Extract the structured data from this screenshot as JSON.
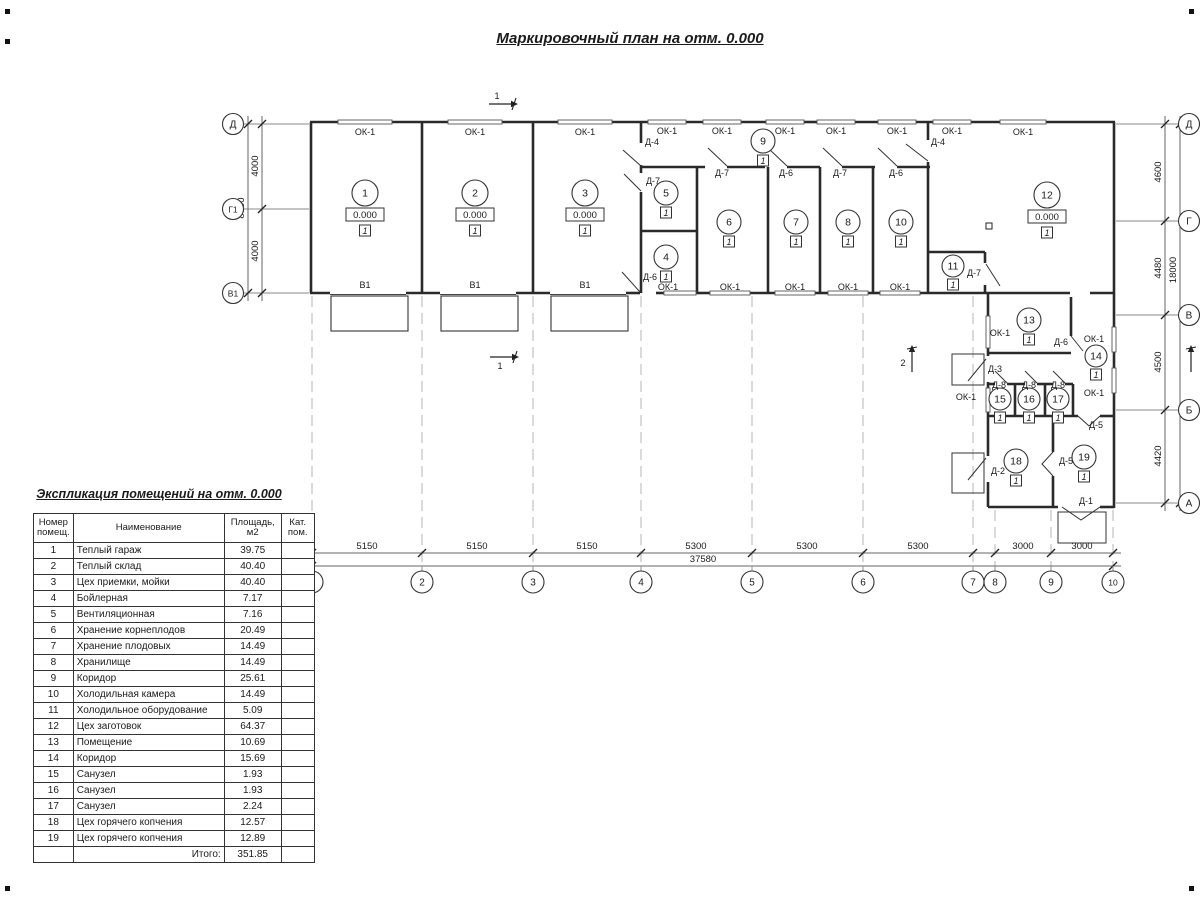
{
  "title": "Маркировочный план на отм. 0.000",
  "explication": {
    "title": "Экспликация помещений на отм. 0.000",
    "headers": {
      "number": "Номер помещ.",
      "name": "Наименование",
      "area": "Площадь, м2",
      "category": "Кат. пом."
    },
    "rows": [
      {
        "number": "1",
        "name": "Теплый гараж",
        "area": "39.75",
        "category": ""
      },
      {
        "number": "2",
        "name": "Теплый склад",
        "area": "40.40",
        "category": ""
      },
      {
        "number": "3",
        "name": "Цех приемки, мойки",
        "area": "40.40",
        "category": ""
      },
      {
        "number": "4",
        "name": "Бойлерная",
        "area": "7.17",
        "category": ""
      },
      {
        "number": "5",
        "name": "Вентиляционная",
        "area": "7.16",
        "category": ""
      },
      {
        "number": "6",
        "name": "Хранение корнеплодов",
        "area": "20.49",
        "category": ""
      },
      {
        "number": "7",
        "name": "Хранение плодовых",
        "area": "14.49",
        "category": ""
      },
      {
        "number": "8",
        "name": "Хранилище",
        "area": "14.49",
        "category": ""
      },
      {
        "number": "9",
        "name": "Коридор",
        "area": "25.61",
        "category": ""
      },
      {
        "number": "10",
        "name": "Холодильная камера",
        "area": "14.49",
        "category": ""
      },
      {
        "number": "11",
        "name": "Холодильное оборудование",
        "area": "5.09",
        "category": ""
      },
      {
        "number": "12",
        "name": "Цех заготовок",
        "area": "64.37",
        "category": ""
      },
      {
        "number": "13",
        "name": "Помещение",
        "area": "10.69",
        "category": ""
      },
      {
        "number": "14",
        "name": "Коридор",
        "area": "15.69",
        "category": ""
      },
      {
        "number": "15",
        "name": "Санузел",
        "area": "1.93",
        "category": ""
      },
      {
        "number": "16",
        "name": "Санузел",
        "area": "1.93",
        "category": ""
      },
      {
        "number": "17",
        "name": "Санузел",
        "area": "2.24",
        "category": ""
      },
      {
        "number": "18",
        "name": "Цех горячего копчения",
        "area": "12.57",
        "category": ""
      },
      {
        "number": "19",
        "name": "Цех горячего копчения",
        "area": "12.89",
        "category": ""
      }
    ],
    "total_label": "Итого:",
    "total_value": "351.85"
  },
  "plan": {
    "rooms": [
      {
        "n": "1",
        "x": 365,
        "y": 193,
        "r": 13,
        "elevation": "0.000",
        "floor": "1"
      },
      {
        "n": "2",
        "x": 475,
        "y": 193,
        "r": 13,
        "elevation": "0.000",
        "floor": "1"
      },
      {
        "n": "3",
        "x": 585,
        "y": 193,
        "r": 13,
        "elevation": "0.000",
        "floor": "1"
      },
      {
        "n": "4",
        "x": 666,
        "y": 257,
        "r": 12,
        "floor": "1"
      },
      {
        "n": "5",
        "x": 666,
        "y": 193,
        "r": 12,
        "floor": "1"
      },
      {
        "n": "6",
        "x": 729,
        "y": 222,
        "r": 12,
        "floor": "1"
      },
      {
        "n": "7",
        "x": 796,
        "y": 222,
        "r": 12,
        "floor": "1"
      },
      {
        "n": "8",
        "x": 848,
        "y": 222,
        "r": 12,
        "floor": "1"
      },
      {
        "n": "9",
        "x": 763,
        "y": 141,
        "r": 12,
        "floor": "1"
      },
      {
        "n": "10",
        "x": 901,
        "y": 222,
        "r": 12,
        "floor": "1"
      },
      {
        "n": "11",
        "x": 953,
        "y": 266,
        "r": 11,
        "floor": "1"
      },
      {
        "n": "12",
        "x": 1047,
        "y": 195,
        "r": 13,
        "elevation": "0.000",
        "floor": "1"
      },
      {
        "n": "13",
        "x": 1029,
        "y": 320,
        "r": 12,
        "floor": "1"
      },
      {
        "n": "14",
        "x": 1096,
        "y": 356,
        "r": 11,
        "floor": "1"
      },
      {
        "n": "15",
        "x": 1000,
        "y": 399,
        "r": 11,
        "floor": "1"
      },
      {
        "n": "16",
        "x": 1029,
        "y": 399,
        "r": 11,
        "floor": "1"
      },
      {
        "n": "17",
        "x": 1058,
        "y": 399,
        "r": 11,
        "floor": "1"
      },
      {
        "n": "18",
        "x": 1016,
        "y": 461,
        "r": 12,
        "floor": "1"
      },
      {
        "n": "19",
        "x": 1084,
        "y": 457,
        "r": 12,
        "floor": "1"
      }
    ],
    "door_labels": [
      {
        "text": "Д-4",
        "x": 652,
        "y": 145
      },
      {
        "text": "Д-4",
        "x": 938,
        "y": 145
      },
      {
        "text": "Д-7",
        "x": 722,
        "y": 176
      },
      {
        "text": "Д-6",
        "x": 786,
        "y": 176
      },
      {
        "text": "Д-7",
        "x": 840,
        "y": 176
      },
      {
        "text": "Д-6",
        "x": 896,
        "y": 176
      },
      {
        "text": "Д-7",
        "x": 653,
        "y": 184
      },
      {
        "text": "Д-6",
        "x": 650,
        "y": 280
      },
      {
        "text": "Д-7",
        "x": 974,
        "y": 276
      },
      {
        "text": "Д-6",
        "x": 1061,
        "y": 345
      },
      {
        "text": "Д-3",
        "x": 995,
        "y": 372
      },
      {
        "text": "Д-8",
        "x": 999,
        "y": 388
      },
      {
        "text": "Д-8",
        "x": 1029,
        "y": 388
      },
      {
        "text": "Д-8",
        "x": 1058,
        "y": 388
      },
      {
        "text": "Д-5",
        "x": 1096,
        "y": 428
      },
      {
        "text": "Д-5",
        "x": 1066,
        "y": 464
      },
      {
        "text": "Д-2",
        "x": 998,
        "y": 474
      },
      {
        "text": "Д-1",
        "x": 1086,
        "y": 504
      }
    ],
    "window_labels": [
      {
        "text": "ОК-1",
        "x": 365,
        "y": 135
      },
      {
        "text": "ОК-1",
        "x": 475,
        "y": 135
      },
      {
        "text": "ОК-1",
        "x": 585,
        "y": 135
      },
      {
        "text": "ОК-1",
        "x": 667,
        "y": 134
      },
      {
        "text": "ОК-1",
        "x": 722,
        "y": 134
      },
      {
        "text": "ОК-1",
        "x": 785,
        "y": 134
      },
      {
        "text": "ОК-1",
        "x": 836,
        "y": 134
      },
      {
        "text": "ОК-1",
        "x": 897,
        "y": 134
      },
      {
        "text": "ОК-1",
        "x": 952,
        "y": 134
      },
      {
        "text": "ОК-1",
        "x": 1023,
        "y": 135
      },
      {
        "text": "ОК-1",
        "x": 668,
        "y": 290
      },
      {
        "text": "ОК-1",
        "x": 730,
        "y": 290
      },
      {
        "text": "ОК-1",
        "x": 795,
        "y": 290
      },
      {
        "text": "ОК-1",
        "x": 848,
        "y": 290
      },
      {
        "text": "ОК-1",
        "x": 900,
        "y": 290
      },
      {
        "text": "ОК-1",
        "x": 1000,
        "y": 336
      },
      {
        "text": "ОК-1",
        "x": 966,
        "y": 400
      },
      {
        "text": "ОК-1",
        "x": 1094,
        "y": 342
      },
      {
        "text": "ОК-1",
        "x": 1094,
        "y": 396
      }
    ],
    "gate_labels": [
      {
        "text": "В1",
        "x": 365,
        "y": 288
      },
      {
        "text": "В1",
        "x": 475,
        "y": 288
      },
      {
        "text": "В1",
        "x": 585,
        "y": 288
      }
    ],
    "axes": {
      "left": {
        "cx": 233,
        "r": 10.5,
        "items": [
          {
            "label": "Д",
            "y": 124
          },
          {
            "label": "Г1",
            "y": 209
          },
          {
            "label": "В1",
            "y": 293
          }
        ]
      },
      "right": {
        "cx": 1189,
        "r": 10.5,
        "items": [
          {
            "label": "Д",
            "y": 124
          },
          {
            "label": "Г",
            "y": 221
          },
          {
            "label": "В",
            "y": 315
          },
          {
            "label": "Б",
            "y": 410
          },
          {
            "label": "А",
            "y": 503
          }
        ]
      },
      "bottom": {
        "cy": 582,
        "r": 11,
        "items": [
          {
            "label": "1",
            "x": 312
          },
          {
            "label": "2",
            "x": 422
          },
          {
            "label": "3",
            "x": 533
          },
          {
            "label": "4",
            "x": 641
          },
          {
            "label": "5",
            "x": 752
          },
          {
            "label": "6",
            "x": 863
          },
          {
            "label": "7",
            "x": 973
          },
          {
            "label": "8",
            "x": 995
          },
          {
            "label": "9",
            "x": 1051
          },
          {
            "label": "10",
            "x": 1113
          }
        ]
      }
    },
    "dimensions": [
      {
        "orient": "v",
        "line": 262,
        "ticks": [
          124,
          209,
          293
        ],
        "labels": [
          {
            "text": "4000",
            "at": 166
          },
          {
            "text": "4000",
            "at": 251
          }
        ]
      },
      {
        "orient": "v",
        "line": 248,
        "ticks": [
          124,
          293
        ],
        "labels": [
          {
            "text": "8000",
            "at": 208
          }
        ]
      },
      {
        "orient": "v",
        "line": 1165,
        "ticks": [
          124,
          221,
          315,
          410,
          503
        ],
        "labels": [
          {
            "text": "4600",
            "at": 172
          },
          {
            "text": "4480",
            "at": 268
          },
          {
            "text": "4500",
            "at": 362
          },
          {
            "text": "4420",
            "at": 456
          }
        ]
      },
      {
        "orient": "v",
        "line": 1180,
        "ticks": [
          124,
          503
        ],
        "labels": [
          {
            "text": "18000",
            "at": 270
          }
        ]
      },
      {
        "orient": "h",
        "line": 553,
        "ticks": [
          312,
          422,
          533,
          641,
          752,
          863,
          973,
          995,
          1051,
          1113
        ],
        "labels": [
          {
            "text": "5150",
            "at": 367
          },
          {
            "text": "5150",
            "at": 477
          },
          {
            "text": "5150",
            "at": 587
          },
          {
            "text": "5300",
            "at": 696
          },
          {
            "text": "5300",
            "at": 807
          },
          {
            "text": "5300",
            "at": 918
          },
          {
            "text": "3000",
            "at": 1023
          },
          {
            "text": "3000",
            "at": 1082
          }
        ]
      },
      {
        "orient": "h",
        "line": 566,
        "ticks": [
          312,
          1113
        ],
        "labels": [
          {
            "text": "37580",
            "at": 703
          }
        ]
      }
    ],
    "section_marks": [
      {
        "label": "1",
        "x": 502,
        "y": 104,
        "dir": "right",
        "lx": 497,
        "ly": 99
      },
      {
        "label": "1",
        "x": 503,
        "y": 357,
        "dir": "right",
        "lx": 500,
        "ly": 369
      },
      {
        "label": "2",
        "x": 912,
        "y": 360,
        "dir": "up",
        "lx": 903,
        "ly": 366
      },
      {
        "label": "",
        "x": 1191,
        "y": 360,
        "dir": "up",
        "lx": 0,
        "ly": 0
      }
    ]
  },
  "colors": {
    "line": "#1b1b1b",
    "wall": "#2a2a2a",
    "dashed_axis": "#b5b5b5",
    "background": "#ffffff"
  }
}
